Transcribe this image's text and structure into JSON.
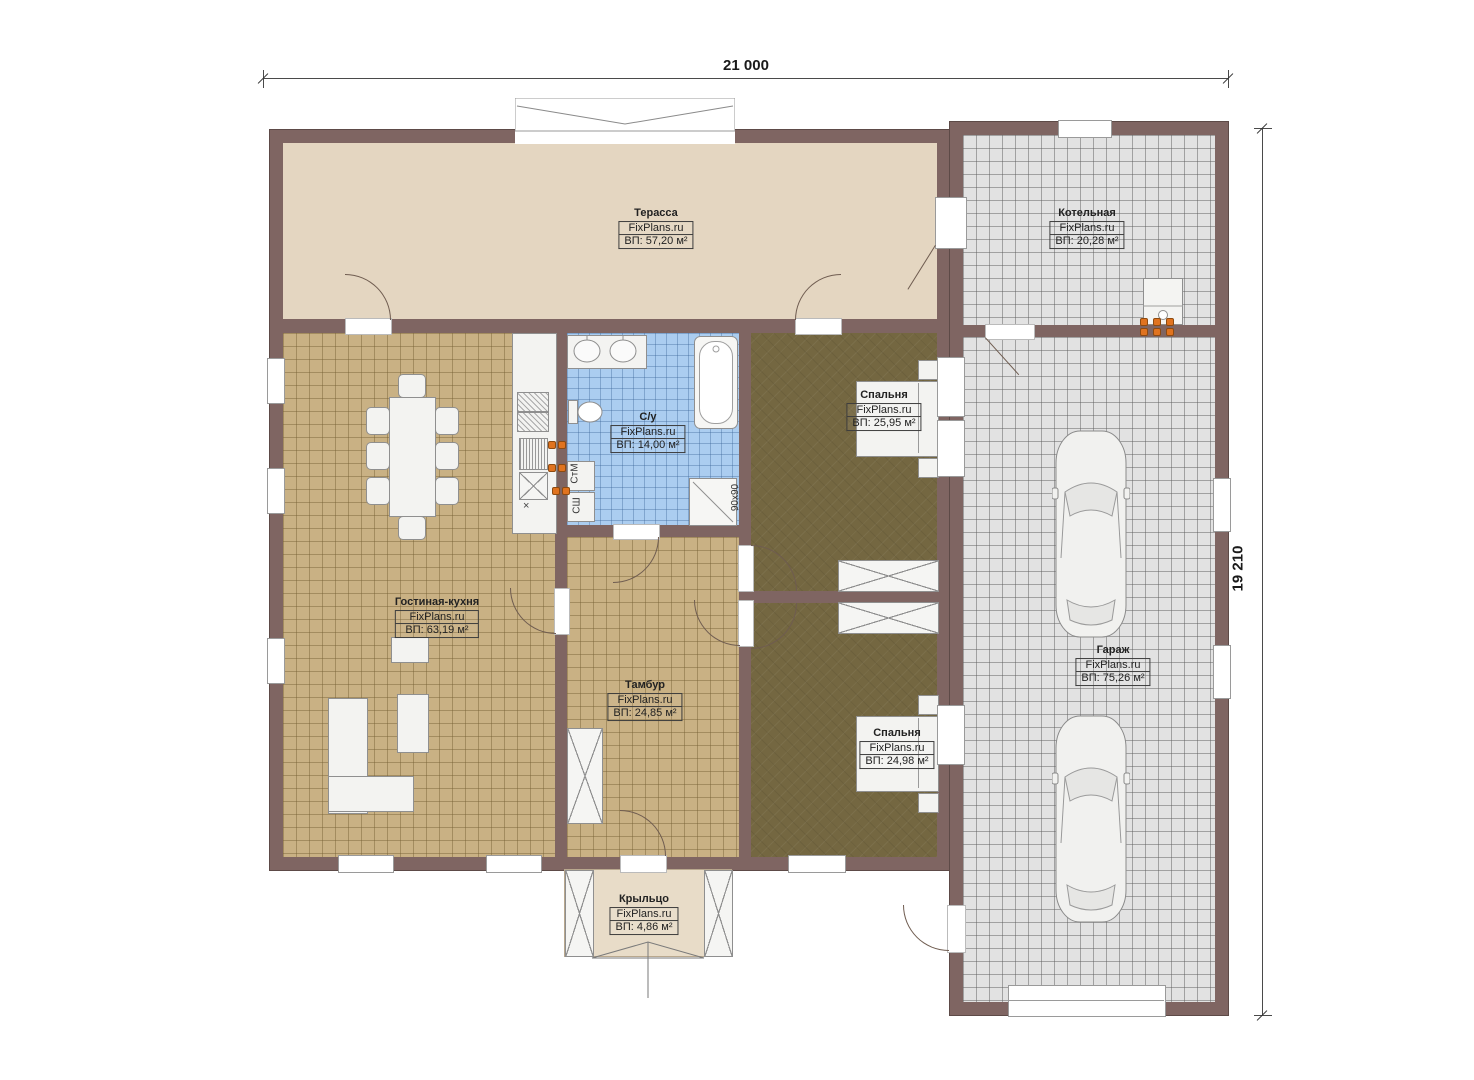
{
  "watermark": "FixPlans.ru",
  "dimensions": {
    "top": "21 000",
    "right": "19 210"
  },
  "rooms": [
    {
      "id": "terrace",
      "name": "Терасса",
      "area": "ВП: 57,20 м²"
    },
    {
      "id": "boiler",
      "name": "Котельная",
      "area": "ВП: 20,28 м²"
    },
    {
      "id": "living",
      "name": "Гостиная-кухня",
      "area": "ВП: 63,19 м²"
    },
    {
      "id": "bath",
      "name": "С/у",
      "area": "ВП: 14,00 м²"
    },
    {
      "id": "bedroom1",
      "name": "Спальня",
      "area": "ВП: 25,95 м²"
    },
    {
      "id": "bedroom2",
      "name": "Спальня",
      "area": "ВП: 24,98 м²"
    },
    {
      "id": "tambour",
      "name": "Тамбур",
      "area": "ВП: 24,85 м²"
    },
    {
      "id": "garage",
      "name": "Гараж",
      "area": "ВП: 75,26 м²"
    },
    {
      "id": "porch",
      "name": "Крыльцо",
      "area": "ВП: 4,86 м²"
    }
  ],
  "annotations": {
    "washing_machine": "СтМ",
    "dryer": "СШ",
    "shower_size": "90х90",
    "kitchen_marker": "×"
  },
  "colors": {
    "wall": "#7f6562",
    "terrace_floor": "#e4d6c1",
    "living_floor": "#c9b184",
    "bath_floor": "#abcdf0",
    "bedroom_floor": "#746741",
    "garage_floor": "#e2e2e2",
    "porch_floor": "#e8dcc8",
    "outlet": "#e0731f"
  }
}
